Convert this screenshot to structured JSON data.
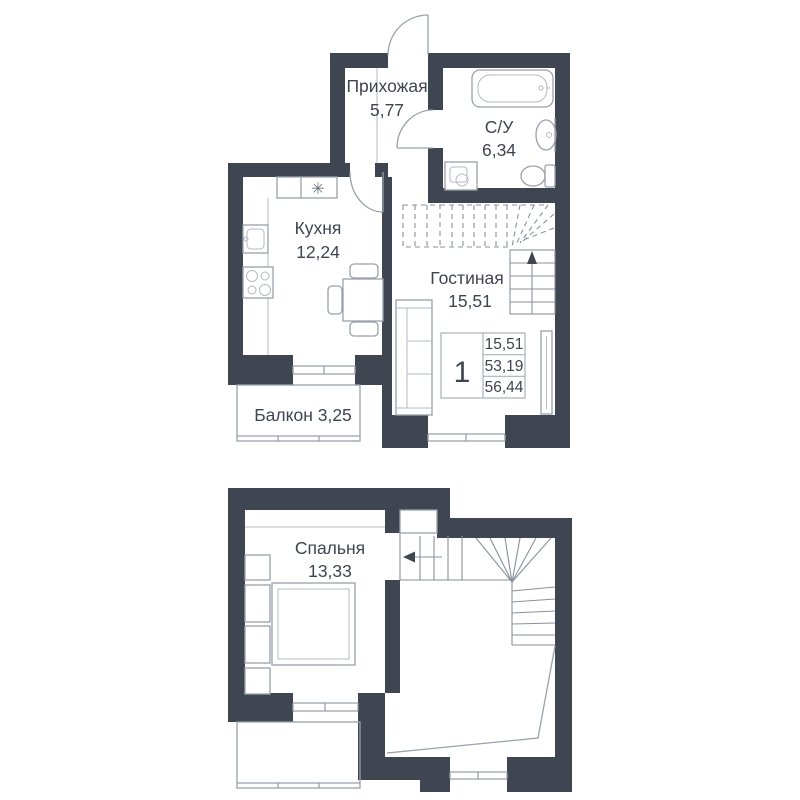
{
  "floorplan": {
    "level1": {
      "hallway": {
        "name": "Прихожая",
        "area": "5,77"
      },
      "bathroom": {
        "name": "С/У",
        "area": "6,34"
      },
      "kitchen": {
        "name": "Кухня",
        "area": "12,24"
      },
      "living": {
        "name": "Гостиная",
        "area": "15,51"
      },
      "balcony_label": "Балкон 3,25",
      "vent_symbol": "✳",
      "info": {
        "rooms": "1",
        "living_area": "15,51",
        "area": "53,19",
        "total": "56,44"
      }
    },
    "level2": {
      "bedroom": {
        "name": "Спальня",
        "area": "13,33"
      }
    },
    "colors": {
      "wall": "#3F4551",
      "lines": "#99A0AB",
      "text": "#3E4450",
      "background": "#FFFFFF"
    }
  }
}
